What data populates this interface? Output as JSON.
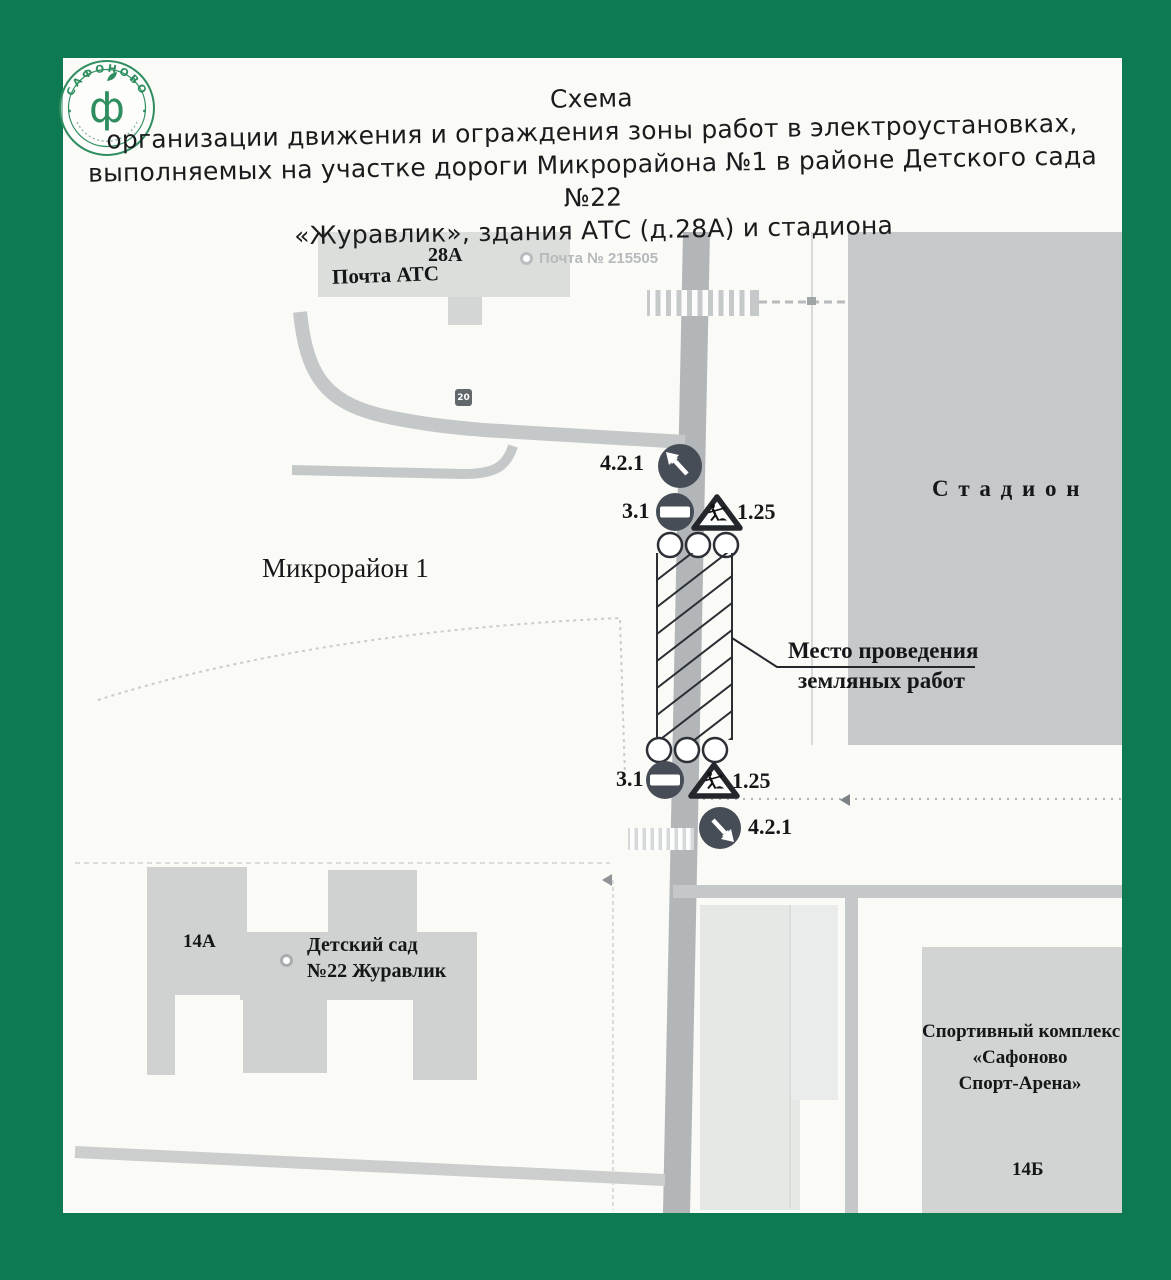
{
  "page": {
    "stamp": {
      "arc_text": "САФОНОВО",
      "center_glyph": "ф"
    },
    "title": {
      "line1": "Схема",
      "line2": "организации движения и ограждения зоны работ в электроустановках,",
      "line3": "выполняемых на участке дороги Микрорайона №1 в районе Детского сада №22",
      "line4": "«Журавлик», здания АТС (д.28А) и стадиона"
    },
    "map": {
      "labels": {
        "post_building_number": "28А",
        "post_building_name": "Почта АТС",
        "post_marker": "Почта № 215505",
        "stadium": "С т а д и о н",
        "district": "Микрорайон 1",
        "work_zone_line1": "Место проведения",
        "work_zone_line2": "земляных работ",
        "kindergarten_number": "14А",
        "kindergarten_line1": "Детский сад",
        "kindergarten_line2": "№22 Журавлик",
        "sport_line1": "Спортивный комплекс",
        "sport_line2": "«Сафоново",
        "sport_line3": "Спорт-Арена»",
        "sport_number": "14Б",
        "speed_badge": "20"
      },
      "signs": {
        "detour_top_label": "4.2.1",
        "no_entry_top_label": "3.1",
        "roadworks_top_label": "1.25",
        "no_entry_bottom_label": "3.1",
        "roadworks_bottom_label": "1.25",
        "detour_bottom_label": "4.2.1"
      },
      "colors": {
        "border_green": "#0d7a52",
        "stamp_green": "#2e8e5f",
        "sign_dark": "#474d56",
        "road_main": "#b2b6b8",
        "road_secondary": "#c5c8c9",
        "building_gray": "#cfd2d0"
      }
    }
  }
}
